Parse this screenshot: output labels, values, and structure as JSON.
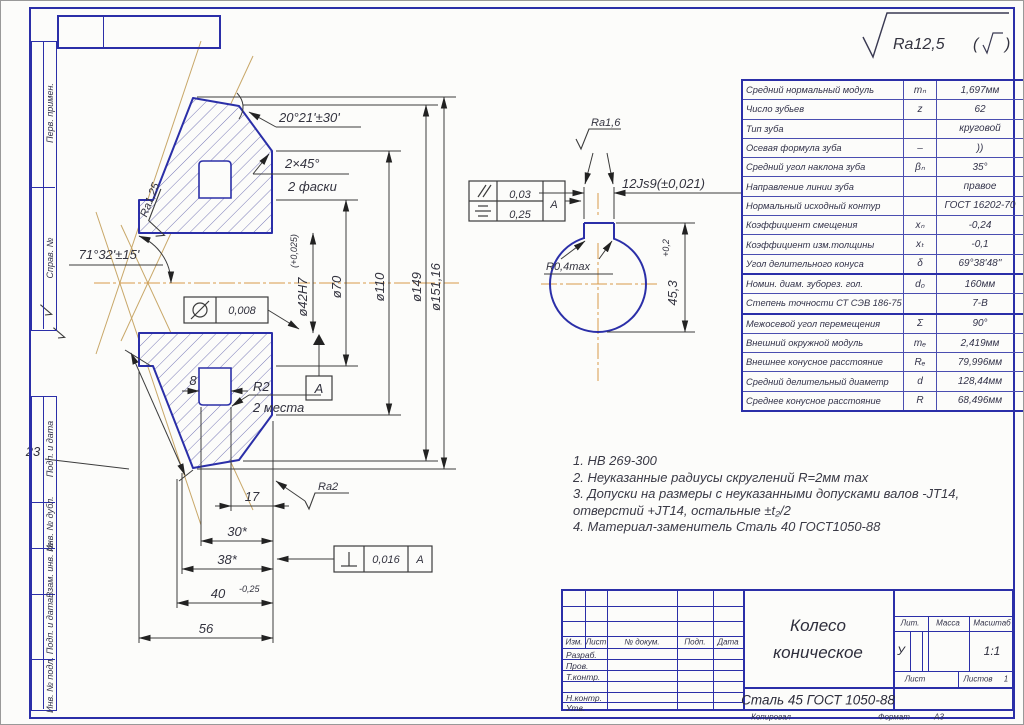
{
  "frame": {
    "copied": "Копировал",
    "format_label": "Формат",
    "format_value": "А3"
  },
  "border_labels": {
    "perv": "Перв. примен.",
    "sprav": "Справ. №",
    "pd1": "Подп. и дата",
    "inv_dub": "Инв. № дубл.",
    "vzam": "Взам. инв. №",
    "pd2": "Подп. и дата",
    "inv_podl": "Инв. № подл."
  },
  "general_roughness": {
    "value": "Ra12,5",
    "paren_open": "(",
    "paren_close": ")"
  },
  "param_table": {
    "rows": [
      {
        "name": "Средний нормальный модуль",
        "sym": "mₙ",
        "val": "1,697мм"
      },
      {
        "name": "Число зубьев",
        "sym": "z",
        "val": "62"
      },
      {
        "name": "Тип зуба",
        "sym": "",
        "val": "круговой"
      },
      {
        "name": "Осевая формула зуба",
        "sym": "–",
        "val": "))"
      },
      {
        "name": "Средний угол наклона зуба",
        "sym": "βₙ",
        "val": "35°"
      },
      {
        "name": "Направление линии зуба",
        "sym": "",
        "val": "правое"
      },
      {
        "name": "Нормальный исходный контур",
        "sym": "",
        "val": "ГОСТ 16202-70"
      },
      {
        "name": "Коэффициент смещения",
        "sym": "xₙ",
        "val": "-0,24"
      },
      {
        "name": "Коэффициент изм.толщины",
        "sym": "xₜ",
        "val": "-0,1"
      },
      {
        "name": "Угол делительного конуса",
        "sym": "δ",
        "val": "69°38'48''"
      },
      {
        "name": "Номин. диам. зуборез. гол.",
        "sym": "d₀",
        "val": "160мм"
      },
      {
        "name": "Степень точности СТ СЭВ 186-75",
        "sym": "",
        "val": "7-В"
      },
      {
        "name": "Межосевой угол перемещения",
        "sym": "Σ",
        "val": "90°"
      },
      {
        "name": "Внешний окружной модуль",
        "sym": "mₑ",
        "val": "2,419мм"
      },
      {
        "name": "Внешнее конусное расстояние",
        "sym": "Rₑ",
        "val": "79,996мм"
      },
      {
        "name": "Средний делительный диаметр",
        "sym": "d",
        "val": "128,44мм"
      },
      {
        "name": "Среднее конусное расстояние",
        "sym": "R",
        "val": "68,496мм"
      }
    ]
  },
  "notes": {
    "line1": "1. НВ 269-300",
    "line2": "2. Неуказанные радиусы скруглений R=2мм max",
    "line3": "3. Допуски на размеры с неуказанными допусками валов -JT14,",
    "line3b": "отверстий +JT14, остальные ±t₂/2",
    "line4": "4. Материал-заменитель Сталь 40 ГОСТ1050-88"
  },
  "dims": {
    "angle_top": "20°21'±30'",
    "chamfer": "2×45°",
    "chamfer_note": "2 фаски",
    "ra125": "Ra1,25",
    "angle_left": "71°32'±15'",
    "cyl_tol": "0,008",
    "d42": "ø42H7",
    "d42_sup": "(+0,025)",
    "d70": "ø70",
    "d110": "ø110",
    "d149": "ø149",
    "d151": "ø151,16",
    "datum": "А",
    "r2": "R2",
    "r2_note": "2 места",
    "w8": "8",
    "w23": "23",
    "w17": "17",
    "ra2": "Ra2",
    "w30": "30*",
    "w38": "38*",
    "w40": "40",
    "w40_sup": "-0,25",
    "w56": "56",
    "perp_val": "0,016",
    "perp_ref": "А"
  },
  "keyway": {
    "ra16": "Ra1,6",
    "par_val": "0,03",
    "sym_val": "0,25",
    "ref": "А",
    "width": "12Js9(±0,021)",
    "r04": "R0,4max",
    "depth": "45,3",
    "depth_sup": "+0,2"
  },
  "title_block": {
    "izm": "Изм.",
    "list": "Лист",
    "ndoc": "№ докум.",
    "podp": "Подп.",
    "data": "Дата",
    "roles": [
      "Разраб.",
      "Пров.",
      "Т.контр.",
      "Н.контр.",
      "Утв."
    ],
    "title1": "Колесо",
    "title2": "коническое",
    "material": "Сталь 45 ГОСТ 1050-88",
    "lit": "Лит.",
    "mass": "Масса",
    "scale": "Масштаб",
    "lit_v": "У",
    "scale_v": "1:1",
    "sheet": "Лист",
    "sheets": "Листов",
    "sheets_v": "1"
  }
}
